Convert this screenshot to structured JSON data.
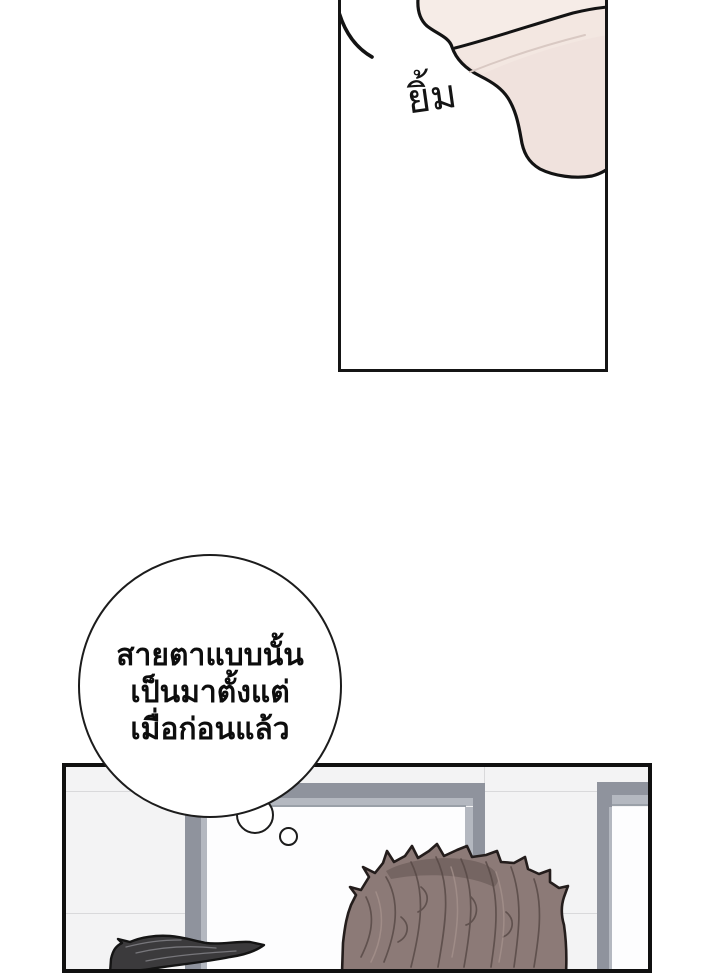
{
  "comic": {
    "panel_top": {
      "sfx_label": "ยิ้ม"
    },
    "thought_bubble": {
      "lines": [
        "สายตาแบบนั้น",
        "เป็นมาตั้งแต่",
        "เมื่อก่อนแล้ว"
      ]
    },
    "colors": {
      "panel_border": "#151515",
      "bubble_outline": "#1c1c1c",
      "bubble_fill": "#ffffff",
      "text": "#0d0d0d",
      "skin_base": "#f0e2dd",
      "skin_light": "#f6ece7",
      "skin_mid": "#f3e7e1",
      "wall": "#f3f3f4",
      "wall_seam": "#d9d9db",
      "door_frame": "#8f939d",
      "door_frame_light": "#b4b8c0",
      "doorway_white": "#fdfdfe",
      "hair_brown": "#8c7a77",
      "hair_brown_dark": "#6f605d",
      "hair_black": "#3b3a3c"
    }
  }
}
